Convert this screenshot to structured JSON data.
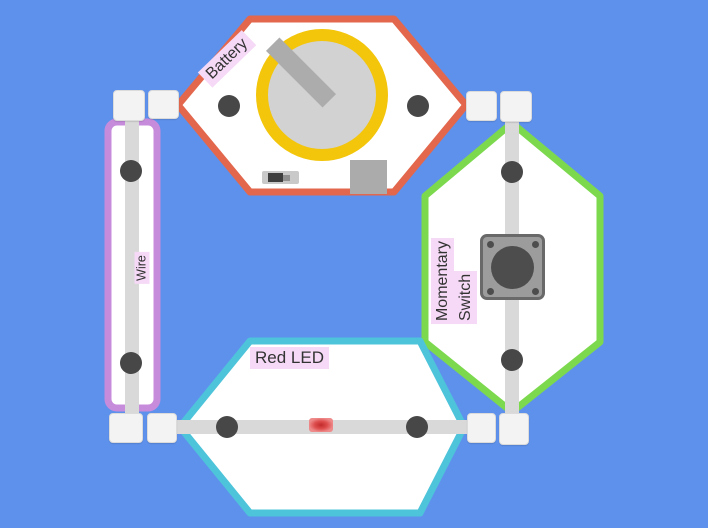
{
  "canvas": {
    "width": 708,
    "height": 528,
    "background_color": "#5E91EC"
  },
  "components": {
    "battery": {
      "label": "Battery",
      "outline_color": "#E2674C",
      "coin_cell_ring_color": "#F3C50B",
      "coin_cell_face_color": "#D2D2D2"
    },
    "momentary_switch": {
      "label_lines": [
        "Momentary",
        "Switch"
      ],
      "outline_color": "#7CD94E",
      "button_color": "#9C9C9C"
    },
    "red_led": {
      "label": "Red LED",
      "outline_color": "#4DC4DA",
      "lit_color": "#D93A3A"
    },
    "wire": {
      "label": "Wire",
      "outline_color": "#C78BDC"
    }
  },
  "label_style": {
    "highlight_color": "#F5D9F6",
    "text_color": "#333333"
  }
}
